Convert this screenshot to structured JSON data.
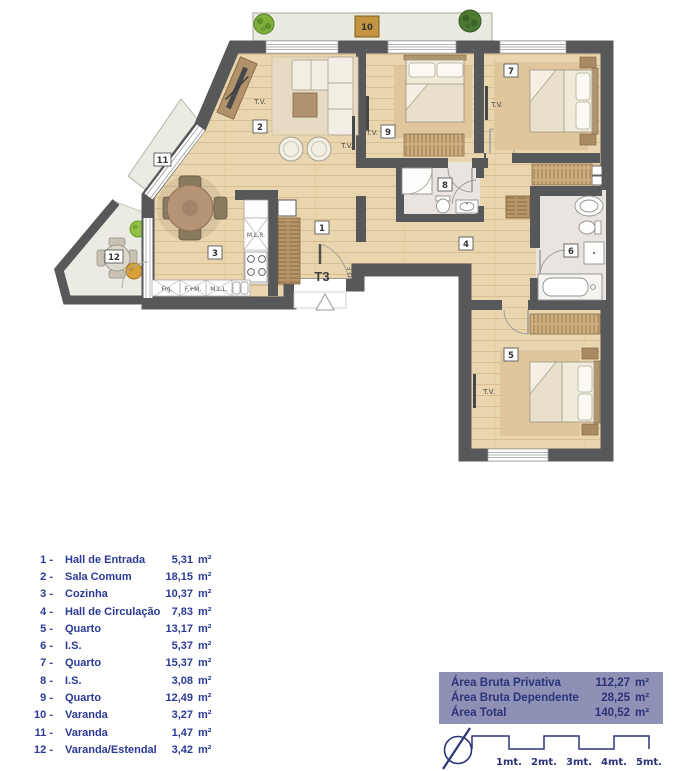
{
  "plan": {
    "unit_type": "T3",
    "tv_label": "T.V.",
    "qe_label": "Q.E.",
    "room_numbers": [
      "1",
      "2",
      "3",
      "4",
      "5",
      "6",
      "7",
      "8",
      "9",
      "10",
      "11",
      "12"
    ],
    "kitchen_labels": {
      "washer": "M.L.R.",
      "fridge": "Frg.",
      "oven": "F.+M.",
      "dishwasher": "M.L.L."
    }
  },
  "legend": {
    "rows": [
      {
        "num": "1 -",
        "name": "Hall de Entrada",
        "value": "5,31",
        "unit": "m²"
      },
      {
        "num": "2 -",
        "name": "Sala Comum",
        "value": "18,15",
        "unit": "m²"
      },
      {
        "num": "3 -",
        "name": "Cozinha",
        "value": "10,37",
        "unit": "m²"
      },
      {
        "num": "4 -",
        "name": "Hall de Circulação",
        "value": "7,83",
        "unit": "m²"
      },
      {
        "num": "5 -",
        "name": "Quarto",
        "value": "13,17",
        "unit": "m²"
      },
      {
        "num": "6 -",
        "name": "I.S.",
        "value": "5,37",
        "unit": "m²"
      },
      {
        "num": "7 -",
        "name": "Quarto",
        "value": "15,37",
        "unit": "m²"
      },
      {
        "num": "8 -",
        "name": "I.S.",
        "value": "3,08",
        "unit": "m²"
      },
      {
        "num": "9 -",
        "name": "Quarto",
        "value": "12,49",
        "unit": "m²"
      },
      {
        "num": "10 -",
        "name": "Varanda",
        "value": "3,27",
        "unit": "m²"
      },
      {
        "num": "11 -",
        "name": "Varanda",
        "value": "1,47",
        "unit": "m²"
      },
      {
        "num": "12 -",
        "name": "Varanda/Estendal",
        "value": "3,42",
        "unit": "m²"
      }
    ]
  },
  "summary": {
    "rows": [
      {
        "label": "Área Bruta Privativa",
        "value": "112,27",
        "unit": "m²"
      },
      {
        "label": "Área Bruta Dependente",
        "value": "28,25",
        "unit": "m²"
      },
      {
        "label": "Área Total",
        "value": "140,52",
        "unit": "m²"
      }
    ]
  },
  "scale_bar": {
    "labels": [
      "1mt.",
      "2mt.",
      "3mt.",
      "4mt.",
      "5mt."
    ]
  },
  "colors": {
    "wall": "#57585a",
    "floor": "#ead6ae",
    "legend_text": "#2b3a94",
    "summary_bg": "#8e90b5",
    "summary_text": "#2b3478"
  }
}
